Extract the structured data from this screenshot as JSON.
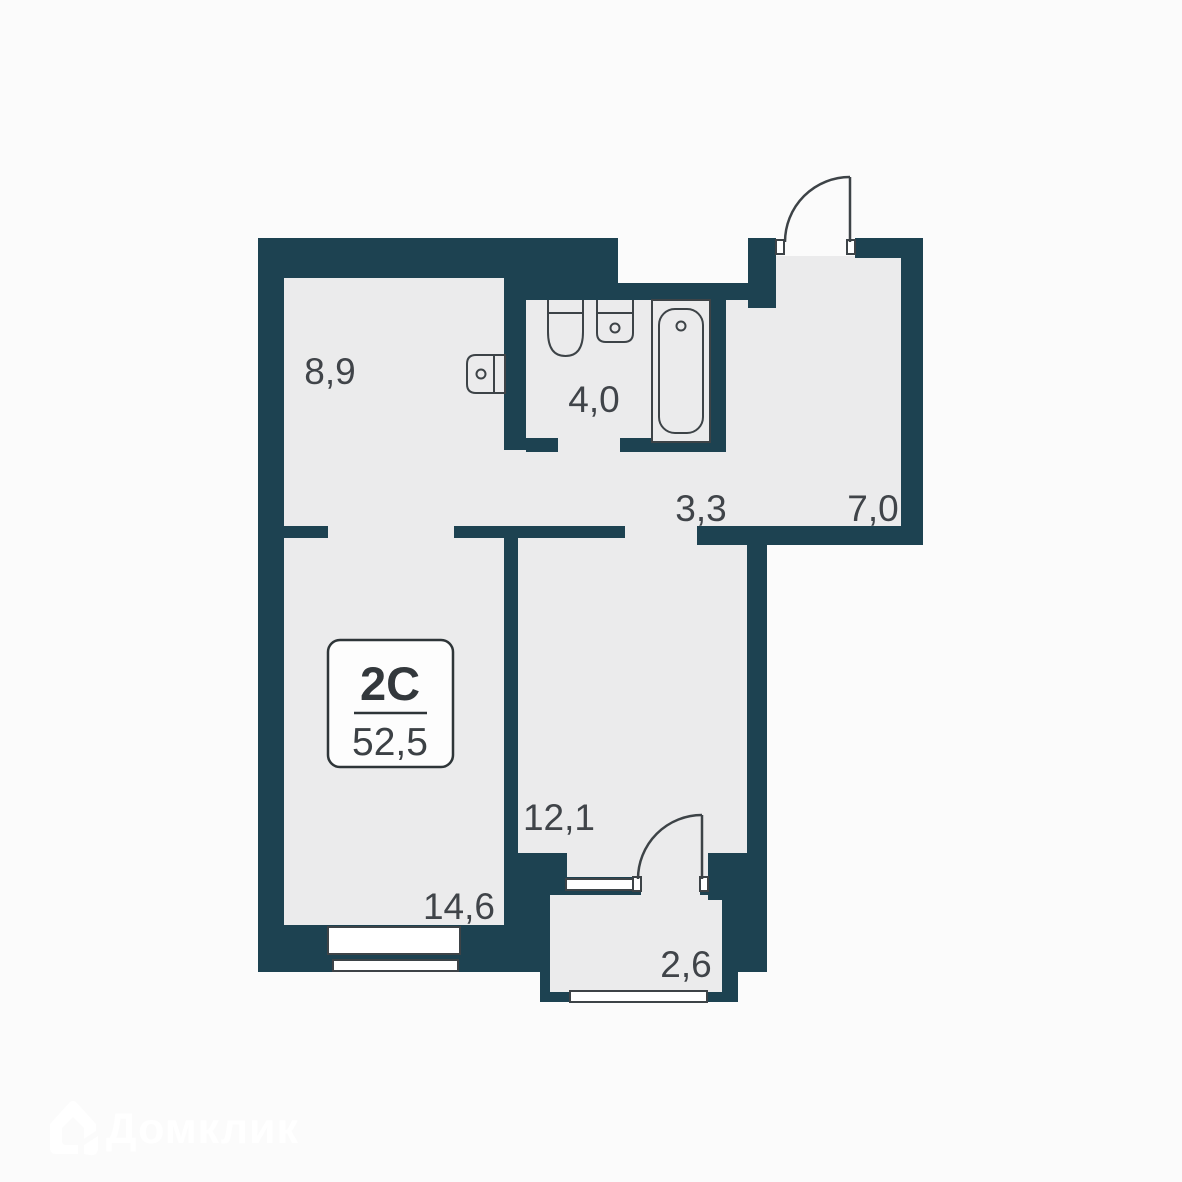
{
  "plan": {
    "badge": {
      "plan_type": "2C",
      "area": "52,5"
    },
    "rooms": [
      {
        "id": "kitchen",
        "area_label": "8,9"
      },
      {
        "id": "bathroom",
        "area_label": "4,0"
      },
      {
        "id": "hallway",
        "area_label": "3,3"
      },
      {
        "id": "entrance",
        "area_label": "7,0"
      },
      {
        "id": "bedroom",
        "area_label": "12,1"
      },
      {
        "id": "living-room",
        "area_label": "14,6"
      },
      {
        "id": "balcony",
        "area_label": "2,6"
      }
    ],
    "fixtures": [
      "kitchen-sink-icon",
      "toilet-icon",
      "bathroom-sink-icon",
      "bathtub-icon",
      "entrance-door-swing-icon",
      "balcony-door-swing-icon"
    ],
    "colors": {
      "wall": "#1d4251",
      "floor": "#ebebec",
      "outline": "#3d4347",
      "label_text": "#404449",
      "background": "#fbfbfb",
      "badge_fill": "#fdfdfd",
      "watermark": "#ffffff"
    }
  },
  "watermark": {
    "label": "Домклик",
    "logo": "domclick-house-icon"
  }
}
